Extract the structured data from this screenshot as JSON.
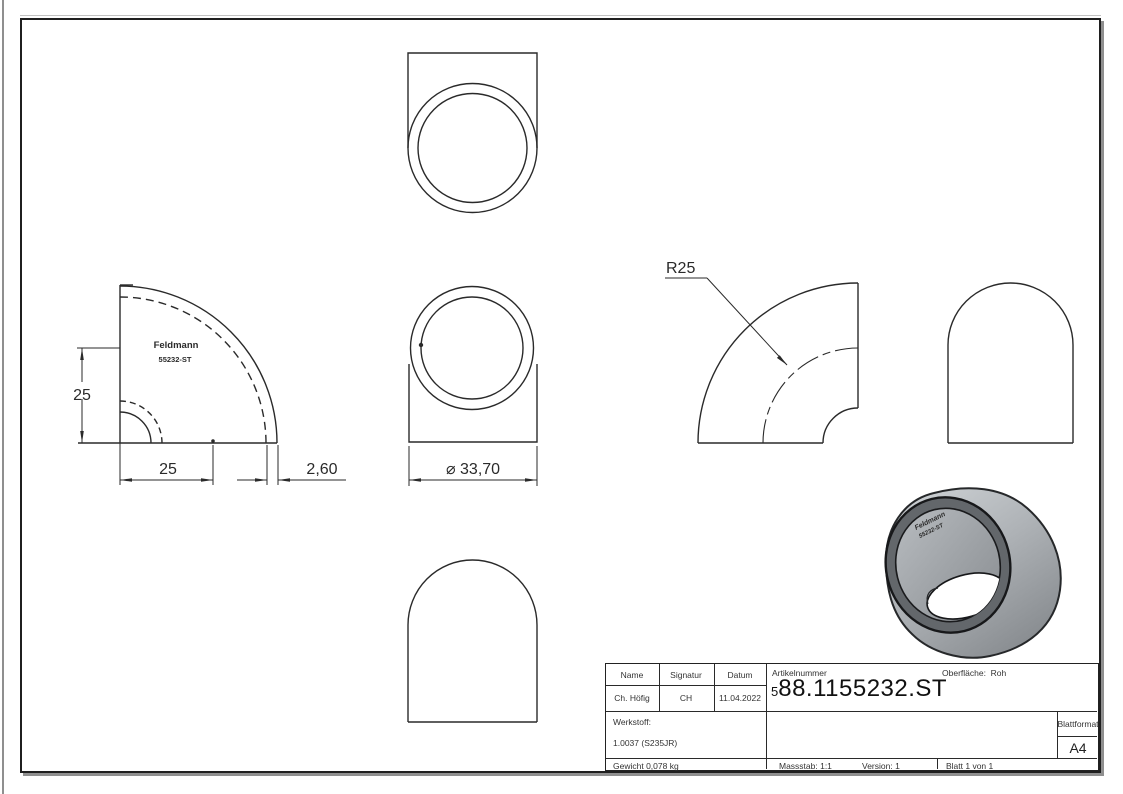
{
  "colors": {
    "line": "#2a2a2a",
    "body_light": "#c9cdd1",
    "body_dark": "#8a8e92",
    "ring_dark": "#63676b",
    "inner_surface": "#a7abaf"
  },
  "views": {
    "side": {
      "label_line1": "Feldmann",
      "label_line2": "55232-ST",
      "dim_vertical": "25",
      "dim_horizontal": "25",
      "dim_wall": "2,60"
    },
    "front": {
      "dim_diameter": "⌀ 33,70"
    },
    "bend": {
      "dim_radius": "R25"
    }
  },
  "render_3d": {
    "label_line1": "Feldmann",
    "label_line2": "55232-ST"
  },
  "title_block": {
    "col_name": "Name",
    "col_signatur": "Signatur",
    "col_datum": "Datum",
    "val_name": "Ch. Höfig",
    "val_signatur": "CH",
    "val_datum": "11.04.2022",
    "artikelnummer_label": "Artikelnummer",
    "artikelnummer_small": "5",
    "artikelnummer_value": "88.1155232.ST",
    "oberflaeche": "Oberfläche:  Roh",
    "werkstoff_label": "Werkstoff:",
    "werkstoff_value": "1.0037 (S235JR)",
    "gewicht": "Gewicht 0,078 kg",
    "blattformat_label": "Blattformat",
    "blattformat_value": "A4",
    "massstab": "Massstab: 1:1",
    "version": "Version: 1",
    "blatt": "Blatt 1 von 1"
  }
}
